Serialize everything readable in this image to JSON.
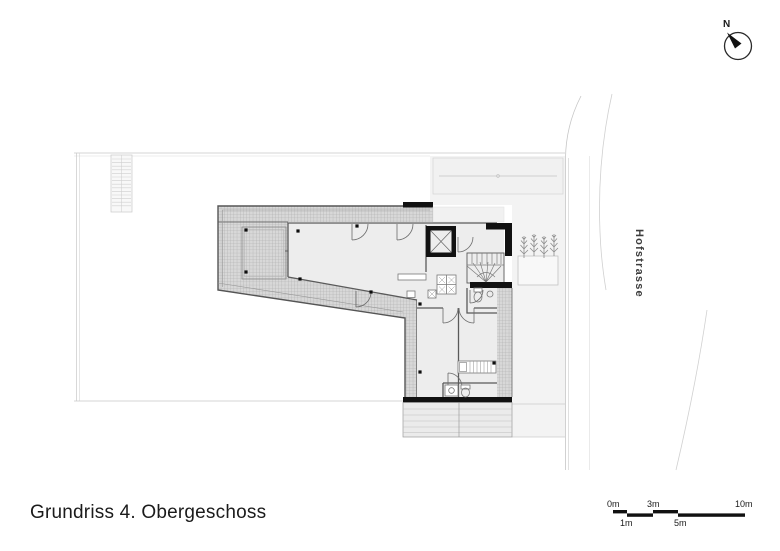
{
  "title": "Grundriss 4. Obergeschoss",
  "compass": {
    "label": "N"
  },
  "street": {
    "name": "Hofstrasse"
  },
  "scale_bar": {
    "zero": "0m",
    "one": "1m",
    "three": "3m",
    "five": "5m",
    "ten": "10m"
  },
  "colors": {
    "wall": "#111111",
    "interior": "#ededed",
    "hatch-bg": "#d8d8d8",
    "hatch-line": "#a9a9a9",
    "parcel": "#f3f3f3",
    "outline": "#555555",
    "boundary": "#c8c8c8",
    "text": "#1b1b1b"
  }
}
